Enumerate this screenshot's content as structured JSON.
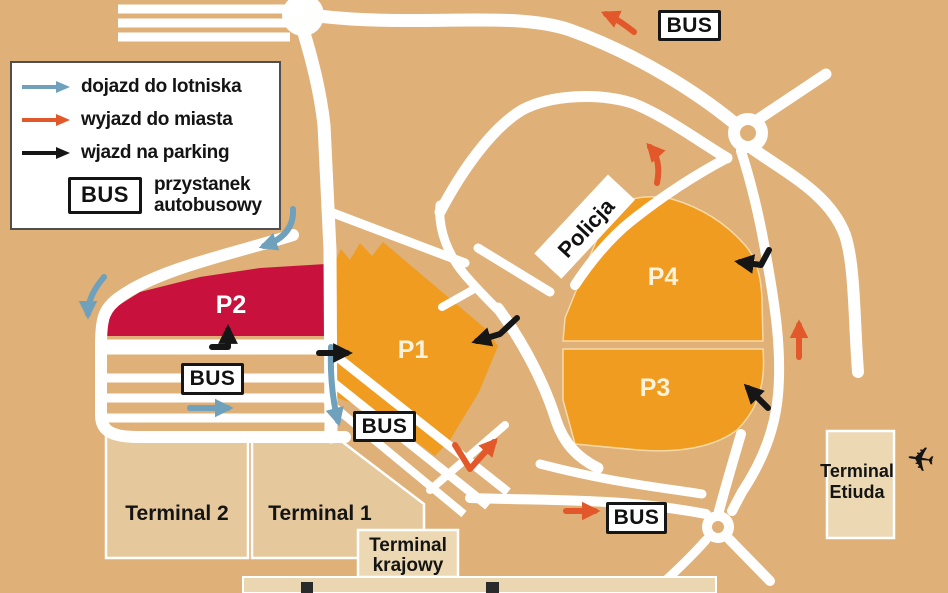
{
  "colors": {
    "background": "#dfb077",
    "road": "#ffffff",
    "parking_orange": "#f09c20",
    "parking_red": "#c8113c",
    "terminal_fill": "#e5c89c",
    "terminal_light": "#ecd9b4",
    "arrow_blue": "#6fa0bc",
    "arrow_orange": "#e2582a",
    "arrow_black": "#161616"
  },
  "legend": {
    "items": [
      {
        "id": "to-airport",
        "label": "dojazd do lotniska",
        "color": "#6fa0bc"
      },
      {
        "id": "to-city",
        "label": "wyjazd do miasta",
        "color": "#e2582a"
      },
      {
        "id": "parking-entry",
        "label": "wjazd na parking",
        "color": "#161616"
      }
    ],
    "bus_symbol": "BUS",
    "bus_label": [
      "przystanek",
      "autobusowy"
    ]
  },
  "map": {
    "bus_label": "BUS",
    "police_label": "Policja",
    "parkings": {
      "p1": "P1",
      "p2": "P2",
      "p3": "P3",
      "p4": "P4"
    },
    "terminals": {
      "terminal2": "Terminal 2",
      "terminal1": "Terminal 1",
      "krajowy": [
        "Terminal",
        "krajowy"
      ],
      "etiuda": [
        "Terminal",
        "Etiuda"
      ]
    },
    "airplane_glyph": "✈"
  }
}
